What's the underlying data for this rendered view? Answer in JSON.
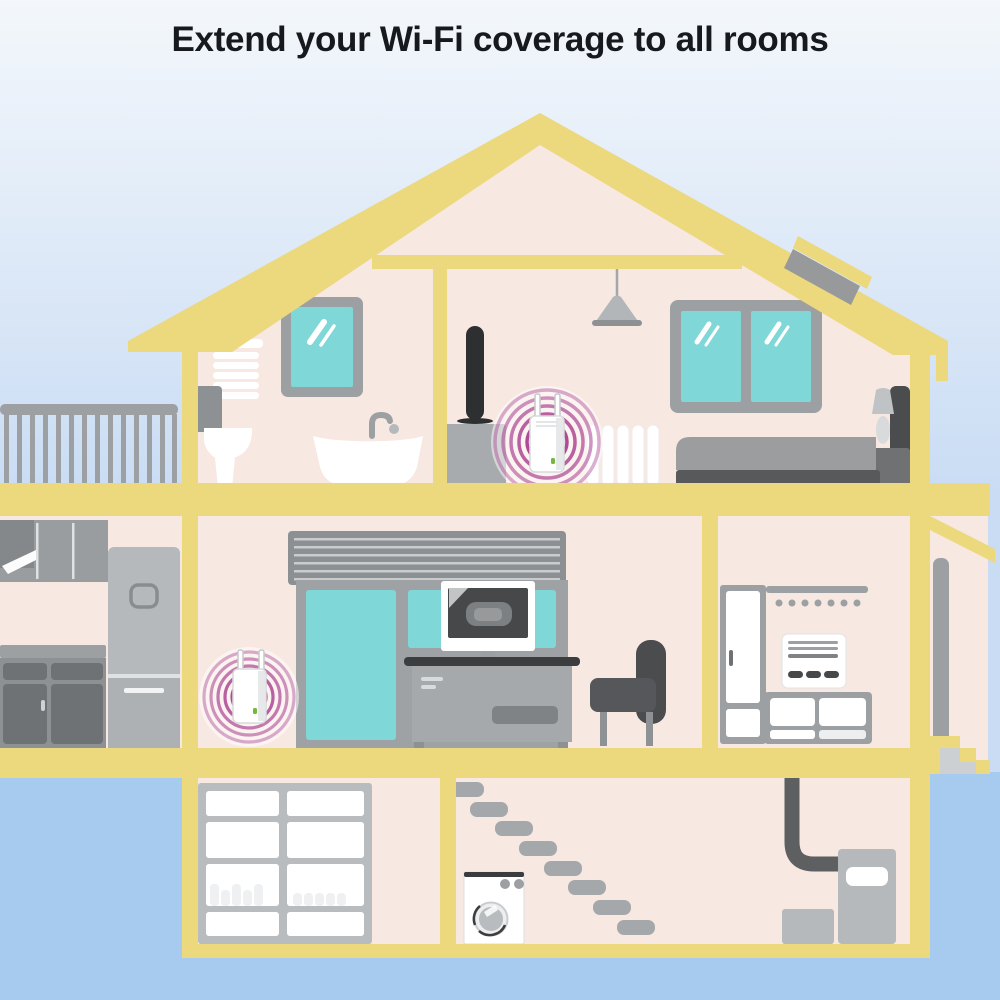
{
  "title": "Extend your Wi-Fi coverage to all rooms",
  "colors": {
    "sky_top": "#F3F7FB",
    "sky_bottom": "#C9DCF4",
    "ground": "#A6CBEE",
    "structure_yellow": "#ECD87D",
    "wall_pink": "#F7E8E1",
    "glass_teal": "#7FD7D8",
    "frame_gray": "#9DA0A2",
    "dark_gray": "#55575A",
    "charcoal": "#2E2F31",
    "appliance_gray": "#B6B9BC",
    "signal_magenta": "#A02C86",
    "led_green": "#76B83F",
    "white": "#FFFFFF",
    "title_color": "#16191D"
  },
  "scene": {
    "wifi_extenders_shown": 2,
    "floors": [
      {
        "level": "top",
        "items": [
          "window blind",
          "window",
          "toilet",
          "bathtub",
          "pendant lamp",
          "speaker",
          "dresser",
          "wifi extender with signal rings",
          "radiator",
          "double window",
          "bed",
          "nightstand lamp",
          "roof skylight"
        ]
      },
      {
        "level": "ground",
        "items": [
          "balcony railing",
          "kitchen cabinets",
          "range hood",
          "fridge",
          "shutter box",
          "sliding glass door",
          "tv",
          "desk",
          "armchair",
          "wifi extender with signal rings",
          "wardrobe",
          "coat rack",
          "wall heater",
          "shoe cabinet",
          "entry porch",
          "downspout",
          "entry steps"
        ]
      },
      {
        "level": "basement",
        "items": [
          "storage shelves with bottles",
          "staircase",
          "washing machine",
          "flue pipe",
          "boiler",
          "storage box"
        ]
      }
    ]
  }
}
